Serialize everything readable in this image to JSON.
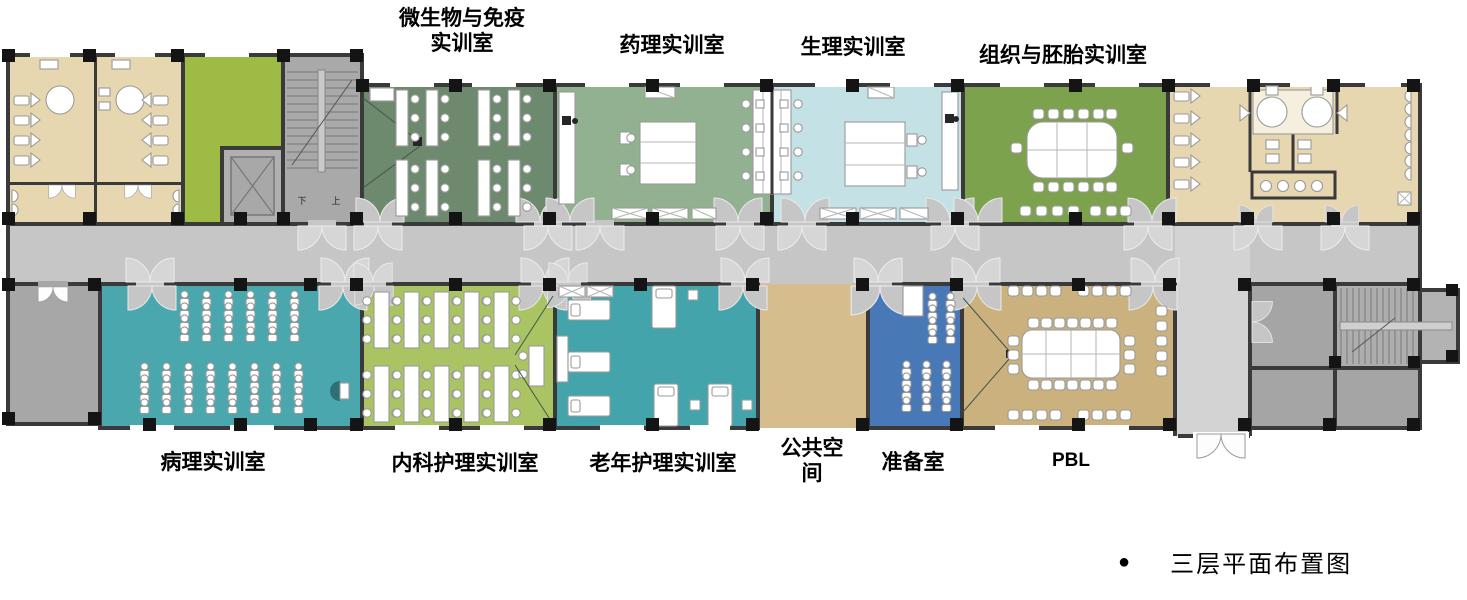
{
  "legend": {
    "bullet": "●",
    "title": "三层平面布置图"
  },
  "stairs": {
    "down_label": "下",
    "up_label": "上"
  },
  "rooms": {
    "restroom_left": {
      "color": "#e7d7b0"
    },
    "green_lobby": {
      "color": "#9ebc45"
    },
    "stairwell_left": {
      "color": "#a9a9a9"
    },
    "microbiology": {
      "label": "微生物与免疫实训室",
      "color": "#6d8a6f"
    },
    "pharmacology": {
      "label": "药理实训室",
      "color": "#92b190"
    },
    "physiology": {
      "label": "生理实训室",
      "color": "#c4e2e6"
    },
    "histology": {
      "label": "组织与胚胎实训室",
      "color": "#7da24e"
    },
    "restroom_right": {
      "color": "#e7d7b0"
    },
    "corridor": {
      "color": "#c6c6c6"
    },
    "gray_room_left": {
      "color": "#a7a7a7"
    },
    "pathology": {
      "label": "病理实训室",
      "color": "#4aa7ae"
    },
    "internal_nursing": {
      "label": "内科护理实训室",
      "color": "#aac464"
    },
    "geriatric_nursing": {
      "label": "老年护理实训室",
      "color": "#43a4ac"
    },
    "public_space": {
      "label": "公共空间",
      "color": "#d6bd8e"
    },
    "prep_room": {
      "label": "准备室",
      "color": "#4878b6"
    },
    "pbl": {
      "label": "PBL",
      "color": "#cab17d"
    },
    "entry_lobby": {
      "color": "#d3d3d3"
    },
    "stair_block": {
      "color": "#a5a5a5"
    },
    "stairwell_right": {
      "color": "#aeaeae"
    }
  }
}
